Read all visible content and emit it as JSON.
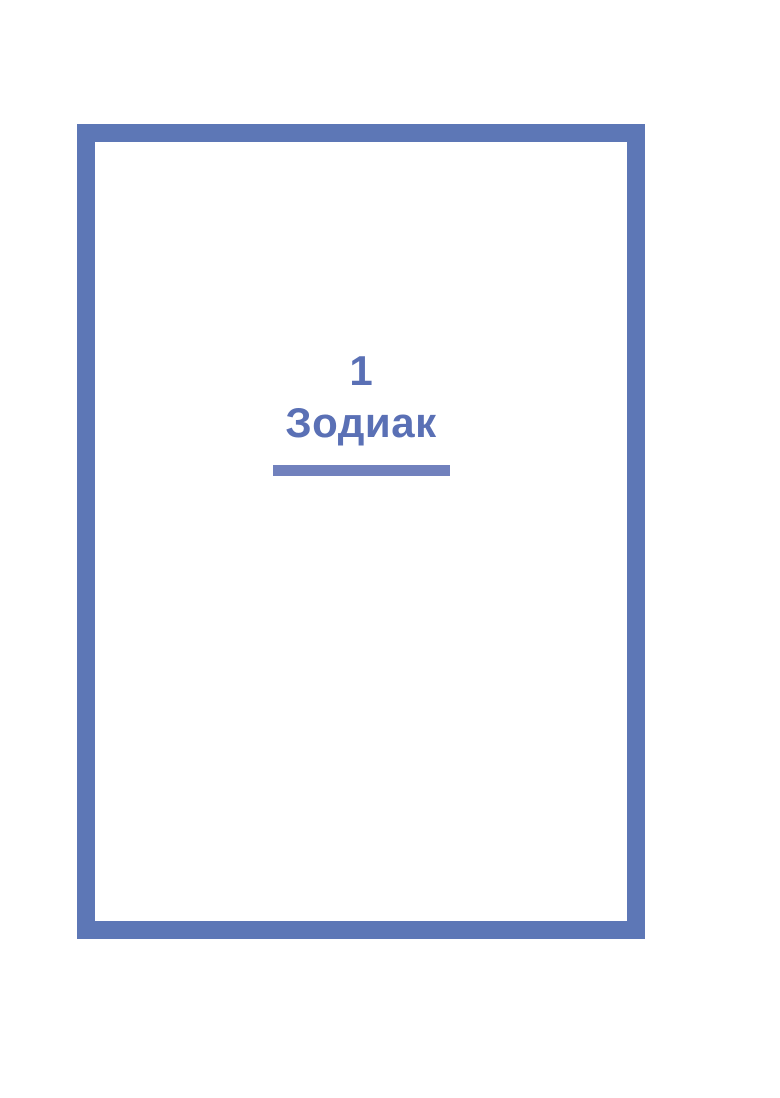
{
  "page": {
    "background_color": "#ffffff",
    "frame_color": "#5d77b6",
    "chapter": {
      "number": "1",
      "title": "Зодиак",
      "text_color": "#5a70b5",
      "rule_color": "#7181bd"
    }
  }
}
